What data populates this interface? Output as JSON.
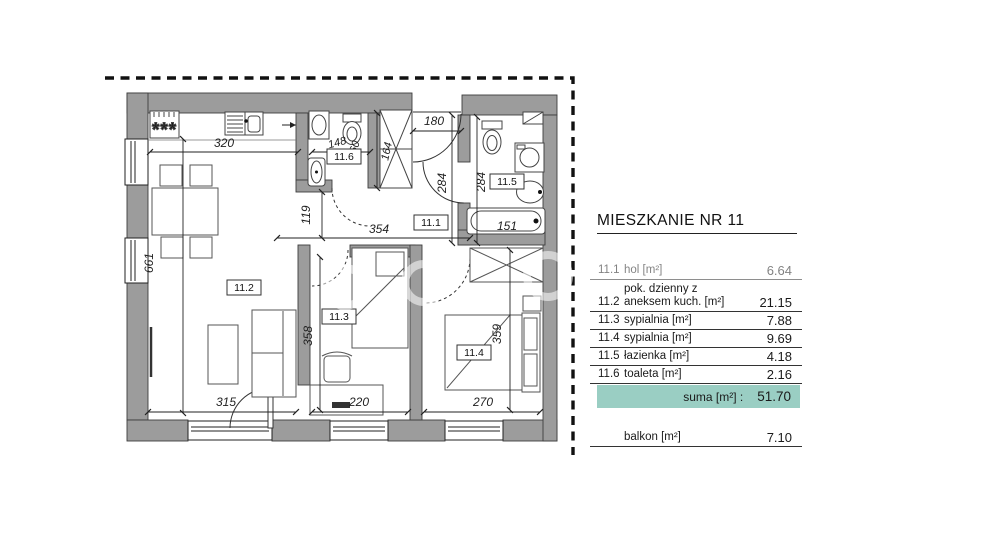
{
  "plan": {
    "room_labels": {
      "hol": "11.1",
      "living": "11.2",
      "bed1": "11.3",
      "bed2": "11.4",
      "bath": "11.5",
      "wc": "11.6"
    },
    "dimensions": {
      "kitchen_width": "320",
      "wc_width": "148",
      "wc_height": "160",
      "wardrobe_height": "164",
      "entrance_width": "180",
      "hall_height": "284",
      "bath_height": "284",
      "passage_height": "119",
      "hall_width": "354",
      "living_height": "661",
      "bed1_height": "358",
      "bed2_height": "359",
      "living_width": "315",
      "bed1_width": "220",
      "bed2_width": "270",
      "bathtub_length": "151"
    }
  },
  "table": {
    "title": "MIESZKANIE NR 11",
    "rows": [
      {
        "no": "11.1",
        "label": "hol [m²]",
        "value": "6.64"
      },
      {
        "no": "11.2",
        "label_line1": "pok. dzienny z",
        "label": "aneksem kuch. [m²]",
        "value": "21.15"
      },
      {
        "no": "11.3",
        "label": "sypialnia [m²]",
        "value": "7.88"
      },
      {
        "no": "11.4",
        "label": "sypialnia [m²]",
        "value": "9.69"
      },
      {
        "no": "11.5",
        "label": "łazienka [m²]",
        "value": "4.18"
      },
      {
        "no": "11.6",
        "label": "toaleta [m²]",
        "value": "2.16"
      }
    ],
    "suma": {
      "label": "suma [m²] :",
      "value": "51.70"
    },
    "balkon": {
      "label": "balkon [m²]",
      "value": "7.10"
    }
  },
  "colors": {
    "wall_gray": "#9c9c9c",
    "suma_highlight": "#9acec3",
    "line_black": "#222222"
  }
}
